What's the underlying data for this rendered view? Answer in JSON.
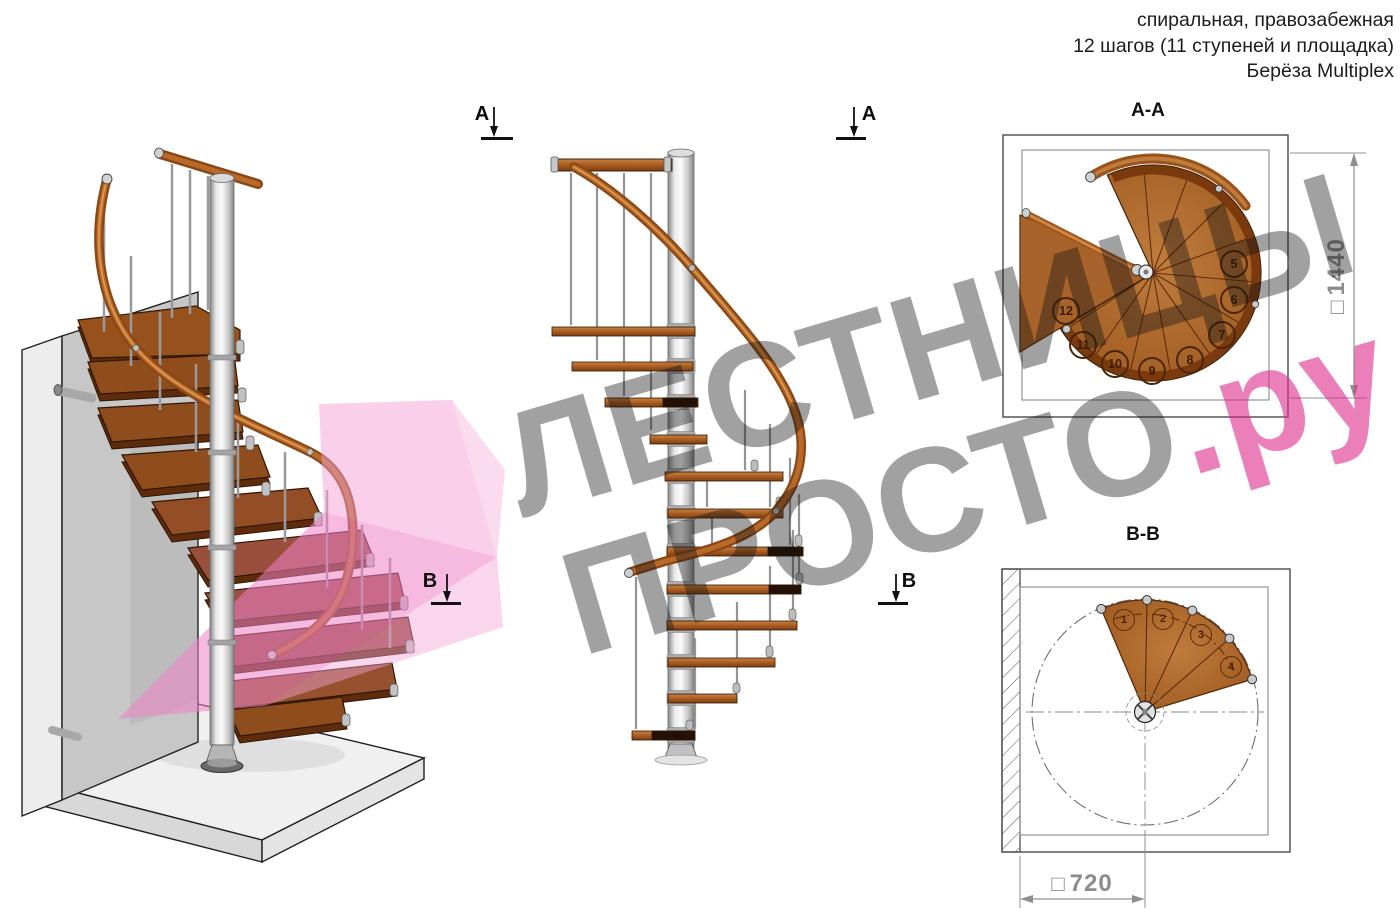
{
  "header": {
    "line1": "спиральная, правозабежная",
    "line2": "12 шагов (11 ступеней и площадка)",
    "line3": "Берёза Multiplex"
  },
  "watermark": {
    "line1": "ЛЕСТНИЦЫ",
    "line2": "ПРОСТО",
    "suffix": ".ру"
  },
  "views": {
    "aa": {
      "title": "А-А",
      "dim_prefix": "□",
      "dim_value": "1440",
      "step_numbers": [
        "5",
        "6",
        "7",
        "8",
        "9",
        "10",
        "11",
        "12"
      ]
    },
    "bb": {
      "title": "В-В",
      "dim_prefix": "□",
      "dim_value": "720",
      "step_numbers": [
        "1",
        "2",
        "3",
        "4"
      ]
    }
  },
  "markers": {
    "a_left": "А",
    "a_right": "А",
    "b_left": "В",
    "b_right": "В"
  },
  "colors": {
    "wood_mid": "#ad6527",
    "wood_dark": "#6e3307",
    "handrail": "#a4581e",
    "metal": "#c6c6c6",
    "pink_overlay": "#ec7ec4",
    "watermark_gray": "#9b9b9b",
    "watermark_pink": "#ea7bb7",
    "dimension_gray": "#8c8c8c"
  }
}
